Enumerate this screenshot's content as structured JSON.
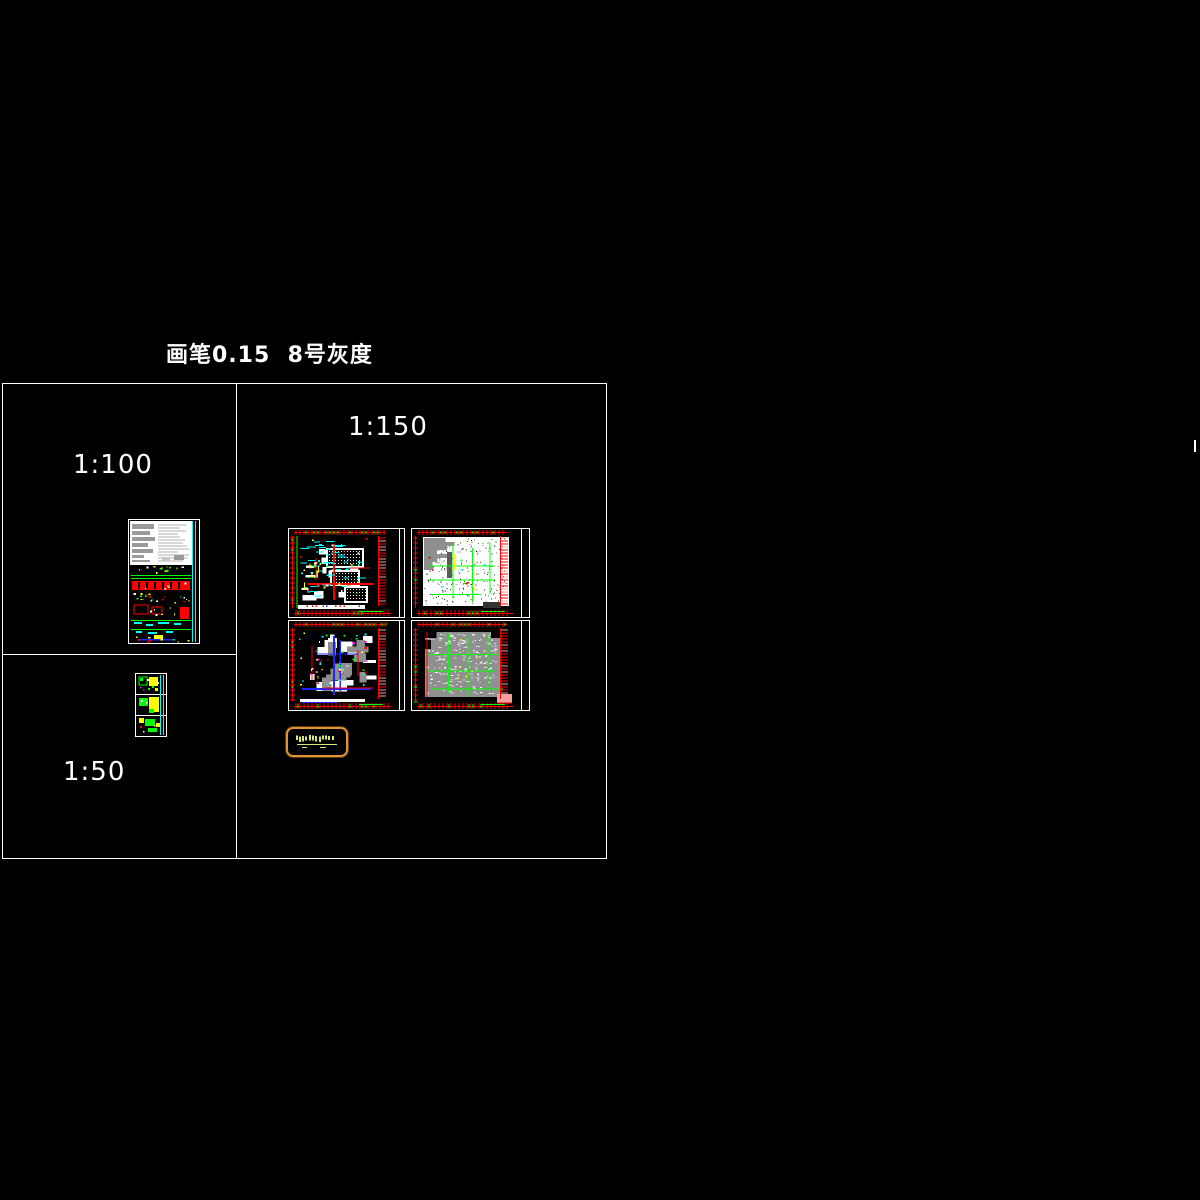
{
  "page": {
    "title": "画笔0.15  8号灰度",
    "background": "#000000"
  },
  "panels": {
    "scale_100": {
      "label": "1:100"
    },
    "scale_150": {
      "label": "1:150"
    },
    "scale_50": {
      "label": "1:50"
    }
  },
  "colors": {
    "frame": "#ffffff",
    "text": "#ffffff",
    "red": "#ff0000",
    "green": "#00ff00",
    "cyan": "#00ffff",
    "yellow": "#ffff00",
    "blue": "#2222ff",
    "magenta": "#ff00ff",
    "gray": "#8f8f8f",
    "dark_gray": "#5a5a5a",
    "light_gray": "#b0b0b0",
    "pink": "#f2a0a0",
    "white": "#ffffff",
    "orange_border": "#e09438",
    "glyph_green": "#d8e87a"
  },
  "thumbnails": {
    "sheet_1_100": {
      "name": "drawing-sheet-1-100",
      "seed": 5
    },
    "sheet_1_50": {
      "name": "drawing-sheet-1-50",
      "seed": 9
    },
    "plans": [
      {
        "name": "floor-plan-top-left",
        "variant": "dense-dark",
        "seed": 7
      },
      {
        "name": "floor-plan-top-right",
        "variant": "light-speckle",
        "seed": 13
      },
      {
        "name": "floor-plan-bottom-left",
        "variant": "gray-blue",
        "seed": 29
      },
      {
        "name": "floor-plan-bottom-right",
        "variant": "gray-green",
        "seed": 47
      }
    ],
    "stamp_box": {
      "name": "title-stamp"
    }
  }
}
